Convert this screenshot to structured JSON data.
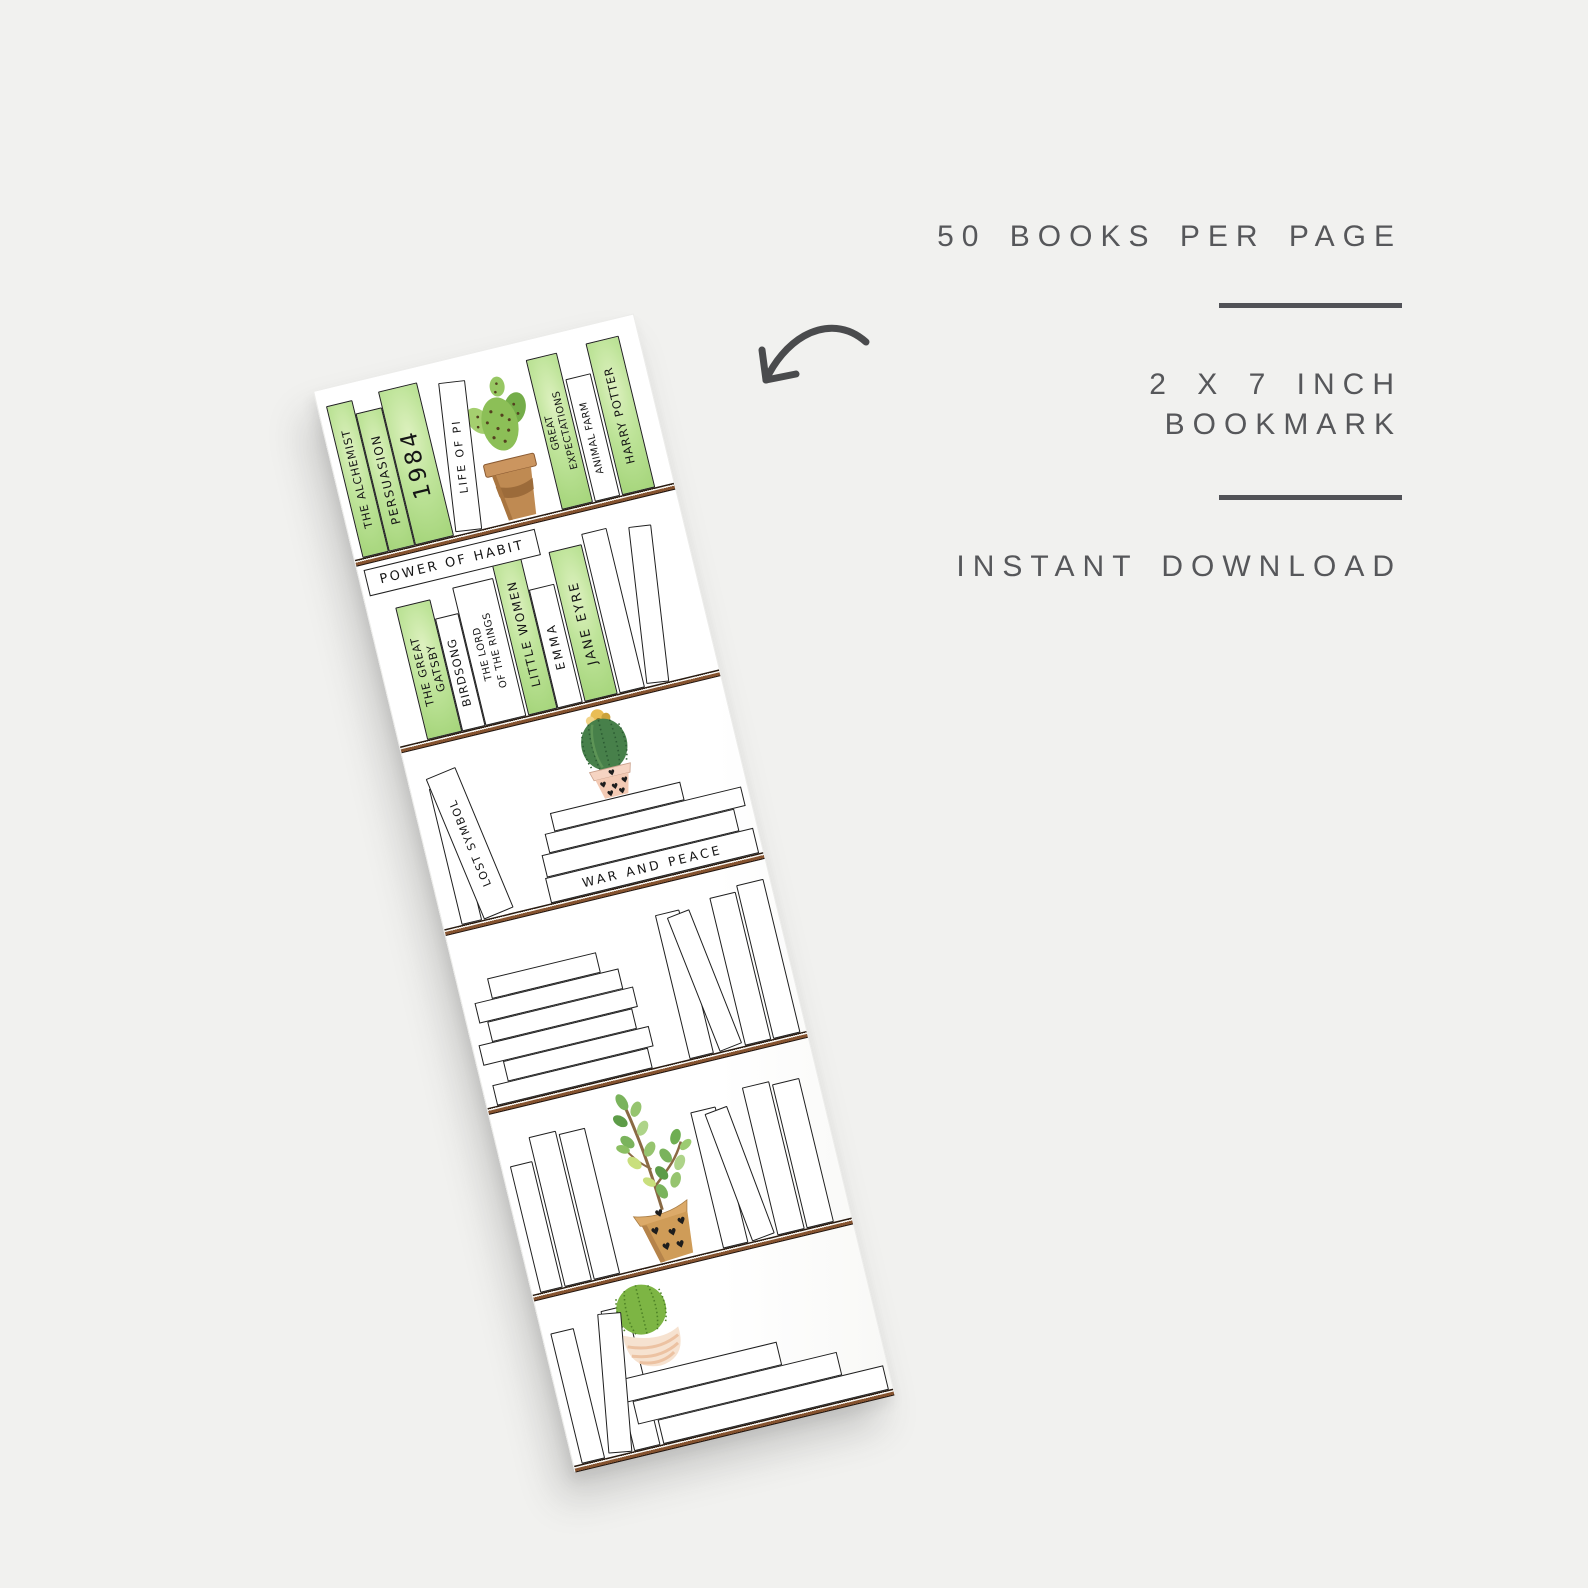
{
  "page": {
    "background_color": "#f1f1ef"
  },
  "info_panel": {
    "books_per_page": "50 BOOKS PER PAGE",
    "size_line_1": "2 X 7 INCH",
    "size_line_2": "BOOKMARK",
    "download": "INSTANT DOWNLOAD",
    "text_color": "#56575a",
    "divider_color": "#515257"
  },
  "arrow": {
    "icon": "curved-arrow",
    "color": "#4a4b4d",
    "direction": "points-down-left-at-bookmark"
  },
  "bookmark": {
    "paper_color": "#ffffff",
    "green_wash_color": "#b7e08d",
    "plank_color": "#86532f",
    "shelves": [
      {
        "name": "shelf-1",
        "decor": "prickly-pear-cactus-in-terracotta-pot",
        "books": [
          {
            "title": "THE ALCHEMIST",
            "style": "green"
          },
          {
            "title": "PERSUASION",
            "style": "green"
          },
          {
            "title": "1984",
            "style": "green"
          },
          {
            "title": "LIFE OF PI",
            "style": "white",
            "lean": "right"
          },
          {
            "lines": [
              "GREAT",
              "EXPECTATIONS"
            ],
            "style": "green"
          },
          {
            "title": "ANIMAL FARM",
            "style": "white"
          },
          {
            "title": "HARRY POTTER",
            "style": "green"
          }
        ]
      },
      {
        "name": "shelf-2",
        "horizontal_book": "POWER OF HABIT",
        "books": [
          {
            "lines": [
              "THE GREAT",
              "GATSBY"
            ],
            "style": "green"
          },
          {
            "title": "BIRDSONG",
            "style": "white"
          },
          {
            "lines": [
              "THE LORD",
              "OF THE RINGS"
            ],
            "style": "white"
          },
          {
            "title": "LITTLE WOMEN",
            "style": "green"
          },
          {
            "title": "EMMA",
            "style": "white"
          },
          {
            "title": "JANE EYRE",
            "style": "green"
          }
        ],
        "empty_books": 2
      },
      {
        "name": "shelf-3",
        "decor": "barrel-cactus-with-flower-in-heart-pot",
        "books": [
          {
            "title": "LOST SYMBOL",
            "style": "white",
            "lean": "left"
          }
        ],
        "stack_bottom_title": "WAR AND PEACE",
        "empty_books": 4
      },
      {
        "name": "shelf-4",
        "empty_books": 10
      },
      {
        "name": "shelf-5",
        "decor": "jade-plant-in-heart-pot",
        "empty_books": 7
      },
      {
        "name": "shelf-6",
        "decor": "globe-cactus-in-swirl-pot",
        "empty_books": 6
      }
    ]
  }
}
